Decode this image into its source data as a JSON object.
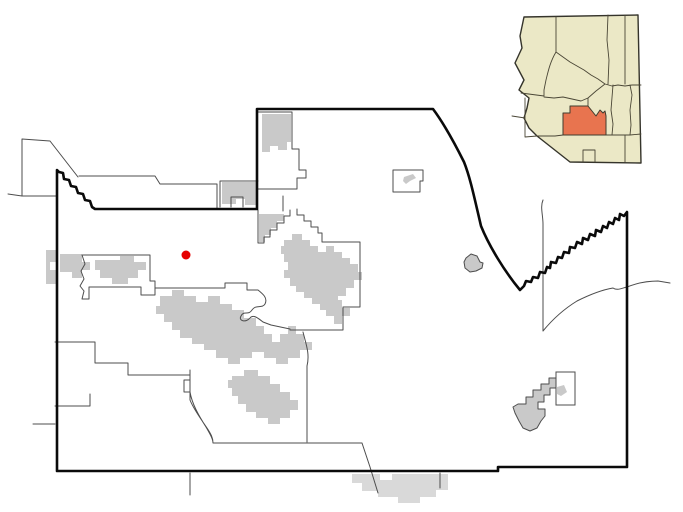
{
  "canvas": {
    "width": 683,
    "height": 512,
    "viewbox": "0 0 683 512",
    "background": "#ffffff"
  },
  "colors": {
    "county_border": "#0a0a0a",
    "municipal_border": "#4d4d4d",
    "urban_area": "#c9c9c9",
    "urban_area_outside": "#d9d9d9",
    "marker": "#e60000",
    "inset_state_fill": "#ebe8c6",
    "inset_state_border": "#35342b",
    "inset_county_border": "#4a4636",
    "inset_highlight_fill": "#e8744f",
    "inset_highlight_border": "#3f3b2d",
    "small_rect_fill": "#ffffff"
  },
  "marker": {
    "cx": 186,
    "cy": 255,
    "r": 4.5
  },
  "geometry": {
    "county_boundary": "M57,170 L59,172 63,173 64,179 69,180 71,186 76,187 78,193 83,194 85,200 90,201 92,207 95,209 L257,209 L257,109 L433,109 C445,125 456,146 464,162 C470,177 474,196 481,226 C489,246 505,272 520,290 L524,286 526,281 531,282 533,277 538,278 540,272 545,273 547,267 550,268 551,262 556,263 558,257 562,258 564,252 569,253 570,247 575,248 577,242 582,244 583,238 588,240 590,234 595,236 596,230 601,232 603,226 607,228 609,222 613,224 615,218 619,220 620,214 624,216 627,212 L627,467 498,467 498,471 57,471 Z",
    "municipal_borders": "M8,194 L22,196 M22,139 L50,141 78,177 M22,139 L22,196 56,196 M79,176 L155,176 160,184 217,184 217,208 M258,112 L292,112 292,149 299,149 299,170 306,170 306,178 297,178 297,189 258,189 M220,181 L258,181 M220,181 L220,207 M231,207 L231,197 243,197 243,207 M258,210 L258,243 264,243 264,237 270,237 270,230 277,230 277,223 284,223 284,216 290,216 290,210 M283,196 L283,211 M297,209 L297,215 304,215 304,221 311,221 311,227 318,227 318,233 322,233 322,242 360,242 360,307 343,307 343,330 290,330 M303,332 C306,344 310,354 307,366 L307,442 M213,443 L362,443 M362,443 L370,467 378,493 M190,370 L190,380 184,380 184,392 190,392 190,400 C194,410 201,419 207,428 211,434 213,438 213,443 M155,288 L225,288 225,283 247,283 247,290 258,290 C263,294 268,298 265,304 262,309 256,304 252,310 248,316 244,310 241,316 238,321 246,323 250,318 253,314 258,318 263,322 L271,325 290,329 M82,255 L150,255 150,281 155,281 155,295 141,295 141,287 89,287 89,299 82,299 84,291 80,286 84,279 81,271 85,264 82,255 M55,342 L95,342 95,363 128,363 128,375 190,375 M190,375 L190,392 C192,404 199,416 206,427 210,434 213,439 213,443 M55,406 L90,406 90,394 M33,424 L55,424 M190,473 L190,495 M440,473 L440,488 M543,200 C540,207 543,215 543,224 L543,331 M543,331 C552,320 564,309 577,301 589,295 601,290 613,288 617,291 622,288 627,287 637,283 648,281 658,281 L670,283 M393,170 L423,170 423,181 420,181 420,192 393,192 Z",
    "urban_areas": "M262,114 L291,114 291,142 287,142 287,150 278,150 278,146 270,146 270,152 262,152 Z M222,182 L257,182 257,205 245,205 245,199 236,199 236,204 222,204 Z M259,214 L284,214 284,221 277,221 277,228 271,228 271,235 265,235 265,242 259,242 Z M284,240 L292,240 292,234 302,234 302,240 310,240 310,246 318,246 318,252 326,252 326,246 334,246 334,252 342,252 342,258 350,258 350,264 358,264 358,272 362,272 362,280 354,280 354,288 346,288 346,296 338,296 338,304 330,304 330,310 320,310 320,304 312,304 312,298 304,298 304,292 296,292 296,286 290,286 290,278 284,278 284,270 288,270 288,262 284,262 284,254 281,254 281,246 284,246 Z M160,296 L172,296 172,290 184,290 184,296 196,296 196,302 208,302 208,296 220,296 220,304 232,304 232,310 244,310 244,318 256,318 256,326 264,326 264,334 272,334 272,342 280,342 280,334 288,334 288,326 296,326 296,334 304,334 304,342 312,342 312,350 300,350 300,358 288,358 288,364 276,364 276,358 264,358 264,352 252,352 252,358 240,358 240,364 228,364 228,358 216,358 216,350 204,350 204,344 192,344 192,338 180,338 180,330 172,330 172,322 164,322 164,314 156,314 156,306 160,306 Z M60,254 L82,254 82,262 90,262 90,270 82,270 82,278 72,278 72,272 60,272 Z M95,260 L120,260 120,256 134,256 134,262 146,262 146,270 138,270 138,278 128,278 128,284 112,284 112,278 100,278 100,270 95,270 Z M46,250 L56,250 56,262 50,262 50,270 56,270 56,284 46,284 Z M232,376 L244,376 244,370 258,370 258,376 270,376 270,384 280,384 280,392 290,392 290,400 298,400 298,410 290,410 290,418 280,418 280,424 268,424 268,418 256,418 256,412 246,412 246,404 238,404 238,396 232,396 232,388 228,388 228,380 232,380 Z M330,300 L342,300 342,308 350,308 350,316 342,316 342,324 334,324 334,316 326,316 326,308 330,308 Z M404,177 L413,174 416,178 410,181 406,184 403,181 Z",
    "urban_areas_outside": "M352,474 L380,474 380,480 392,480 392,474 448,474 448,490 436,490 436,497 420,497 420,503 398,503 398,497 378,497 378,491 362,491 362,483 352,483 Z",
    "urban_outlined": "M518,404 L526,404 526,397 533,397 533,390 541,390 541,384 549,384 549,378 557,378 557,388 550,388 550,395 544,395 544,402 538,402 538,409 545,409 545,416 541,421 537,428 530,431 523,428 519,421 515,413 513,407 Z M466,258 L471,254 477,256 480,262 483,263 482,268 476,271 470,272 465,268 464,262 Z",
    "small_rect": "M556,372 L575,372 575,405 556,405 Z",
    "small_rect_wisp": "M557,387 L564,385 567,392 561,396 557,394 Z",
    "inset_outline": "M524,17 L638,15 641,163 570,162 537,136 529,128 524,118 527,108 529,98 519,90 524,80 515,63 522,48 520,36 Z",
    "inset_county_lines": "M556,17 L556,52 M556,52 C550,62 548,72 546,80 L544,90 544,96 M544,96 L521,93 M525,98 L525,137 M512,116 L525,118 M525,137 L537,136 M556,52 L563,57 570,62 577,66 584,70 591,75 598,79 605,84 M608,15 L607,40 609,60 608,84 M625,15 L625,84 M605,84 L612,86 618,85 625,86 632,85 641,85 M544,97 L554,98 563,97 572,99 581,101 588,98 596,91 605,84 M588,98 L588,106 M613,85 L611,110 613,124 612,135 M630,85 L632,95 630,110 631,125 630,135 M605,135 L613,135 630,135 641,134 M625,135 L625,162 M583,150 L595,150 M583,150 L583,162 M595,150 L595,162 M537,136 L555,136 563,135",
    "inset_highlight": "M563,113 L570,113 570,106 588,106 592,111 596,116 600,110 603,113 605,111 606,116 606,135 563,135 Z"
  }
}
